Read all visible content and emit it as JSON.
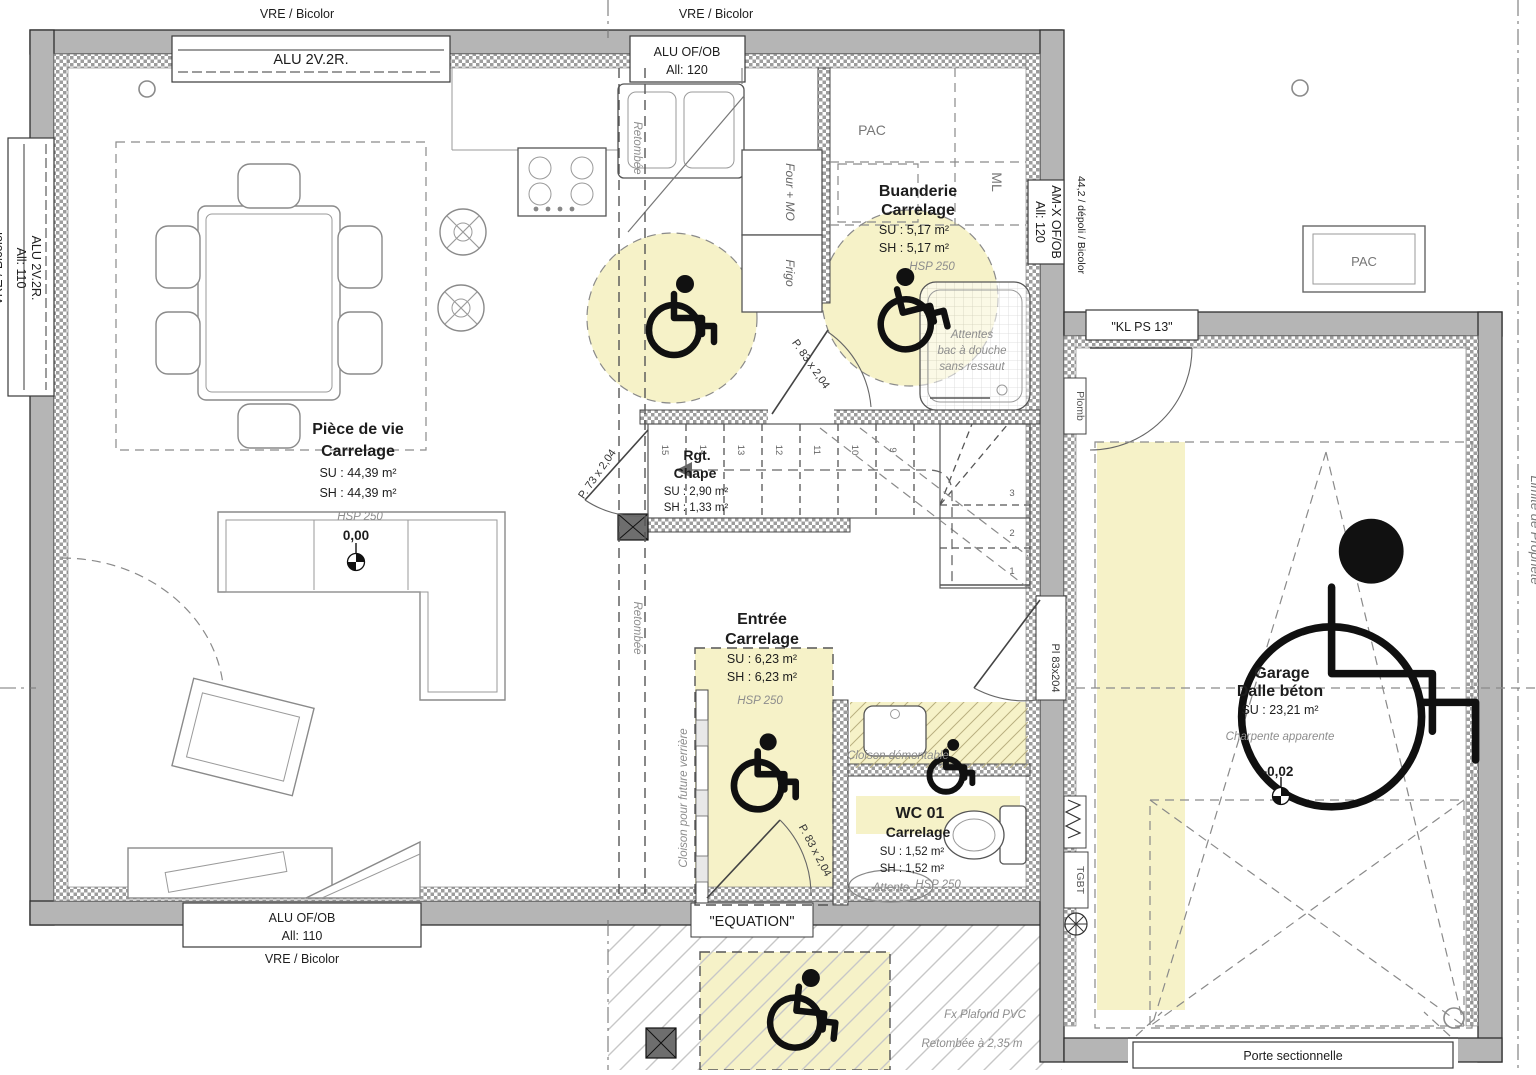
{
  "windows": {
    "top_left": {
      "label": "ALU 2V.2R.",
      "note": "VRE / Bicolor"
    },
    "top_mid": {
      "label": "ALU OF/OB",
      "sill": "All: 120",
      "note": "VRE / Bicolor"
    },
    "left": {
      "label": "ALU 2V.2R.",
      "sill": "All: 110",
      "note": "VRE / Bicolor"
    },
    "bottom": {
      "label": "ALU OF/OB",
      "sill": "All: 110",
      "note": "VRE / Bicolor"
    },
    "right": {
      "label": "AM-X OF/OB",
      "sill": "All: 120",
      "note": "44,2 / dépoli / Bicolor"
    }
  },
  "rooms": {
    "piece_de_vie": {
      "name": "Pièce de vie",
      "finish": "Carrelage",
      "su": "SU : 44,39 m²",
      "sh": "SH : 44,39 m²",
      "hsp": "HSP 250",
      "level": "0,00"
    },
    "buanderie": {
      "name": "Buanderie",
      "finish": "Carrelage",
      "su": "SU : 5,17 m²",
      "sh": "SH : 5,17 m²",
      "hsp": "HSP 250",
      "note1": "Attentes",
      "note2": "bac à douche",
      "note3": "sans ressaut"
    },
    "rgt": {
      "name": "Rgt.",
      "finish": "Chape",
      "su": "SU : 2,90 m²",
      "sh": "SH : 1,33 m²"
    },
    "entree": {
      "name": "Entrée",
      "finish": "Carrelage",
      "su": "SU : 6,23 m²",
      "sh": "SH : 6,23 m²",
      "hsp": "HSP 250"
    },
    "wc": {
      "name": "WC 01",
      "finish": "Carrelage",
      "su": "SU : 1,52 m²",
      "sh": "SH : 1,52 m²",
      "hsp": "HSP 250",
      "note": "Attente"
    },
    "garage": {
      "name": "Garage",
      "finish": "Dalle béton",
      "su": "SU : 23,21 m²",
      "note": "Charpente apparente",
      "level": "-0,02"
    },
    "pac_room": "PAC",
    "ml": "ML",
    "pac_ext": "PAC"
  },
  "doors": {
    "rgt": "P. 73 x 2,04",
    "buanderie": "P. 83 x 2,04",
    "entree": "P. 83 x 2,04",
    "pl": "Pl 83x204",
    "kl": "\"KL PS 13\"",
    "equation": "\"EQUATION\"",
    "sectionnelle": "Porte sectionnelle"
  },
  "annotations": {
    "retombee": "Retombée",
    "retombee2": "Retombée",
    "cloison_verriere": "Cloison pour future verrière",
    "cloison_demontable": "Cloison démontable",
    "four_mo": "Four + MO",
    "frigo": "Frigo",
    "plomb": "Plomb",
    "tgbt": "TGBT",
    "limite": "Limite de Propriété",
    "fx_plafond": "Fx Plafond PVC",
    "retombee_plafond": "Retombée à 2,35 m"
  },
  "stairs": {
    "up": [
      "15",
      "14",
      "13",
      "12",
      "11",
      "10",
      "9"
    ],
    "down": [
      "3",
      "2",
      "1"
    ]
  },
  "colors": {
    "wall": "#b5b5b5",
    "highlight": "#f6f2c8",
    "annotation": "#8d8d8d"
  }
}
